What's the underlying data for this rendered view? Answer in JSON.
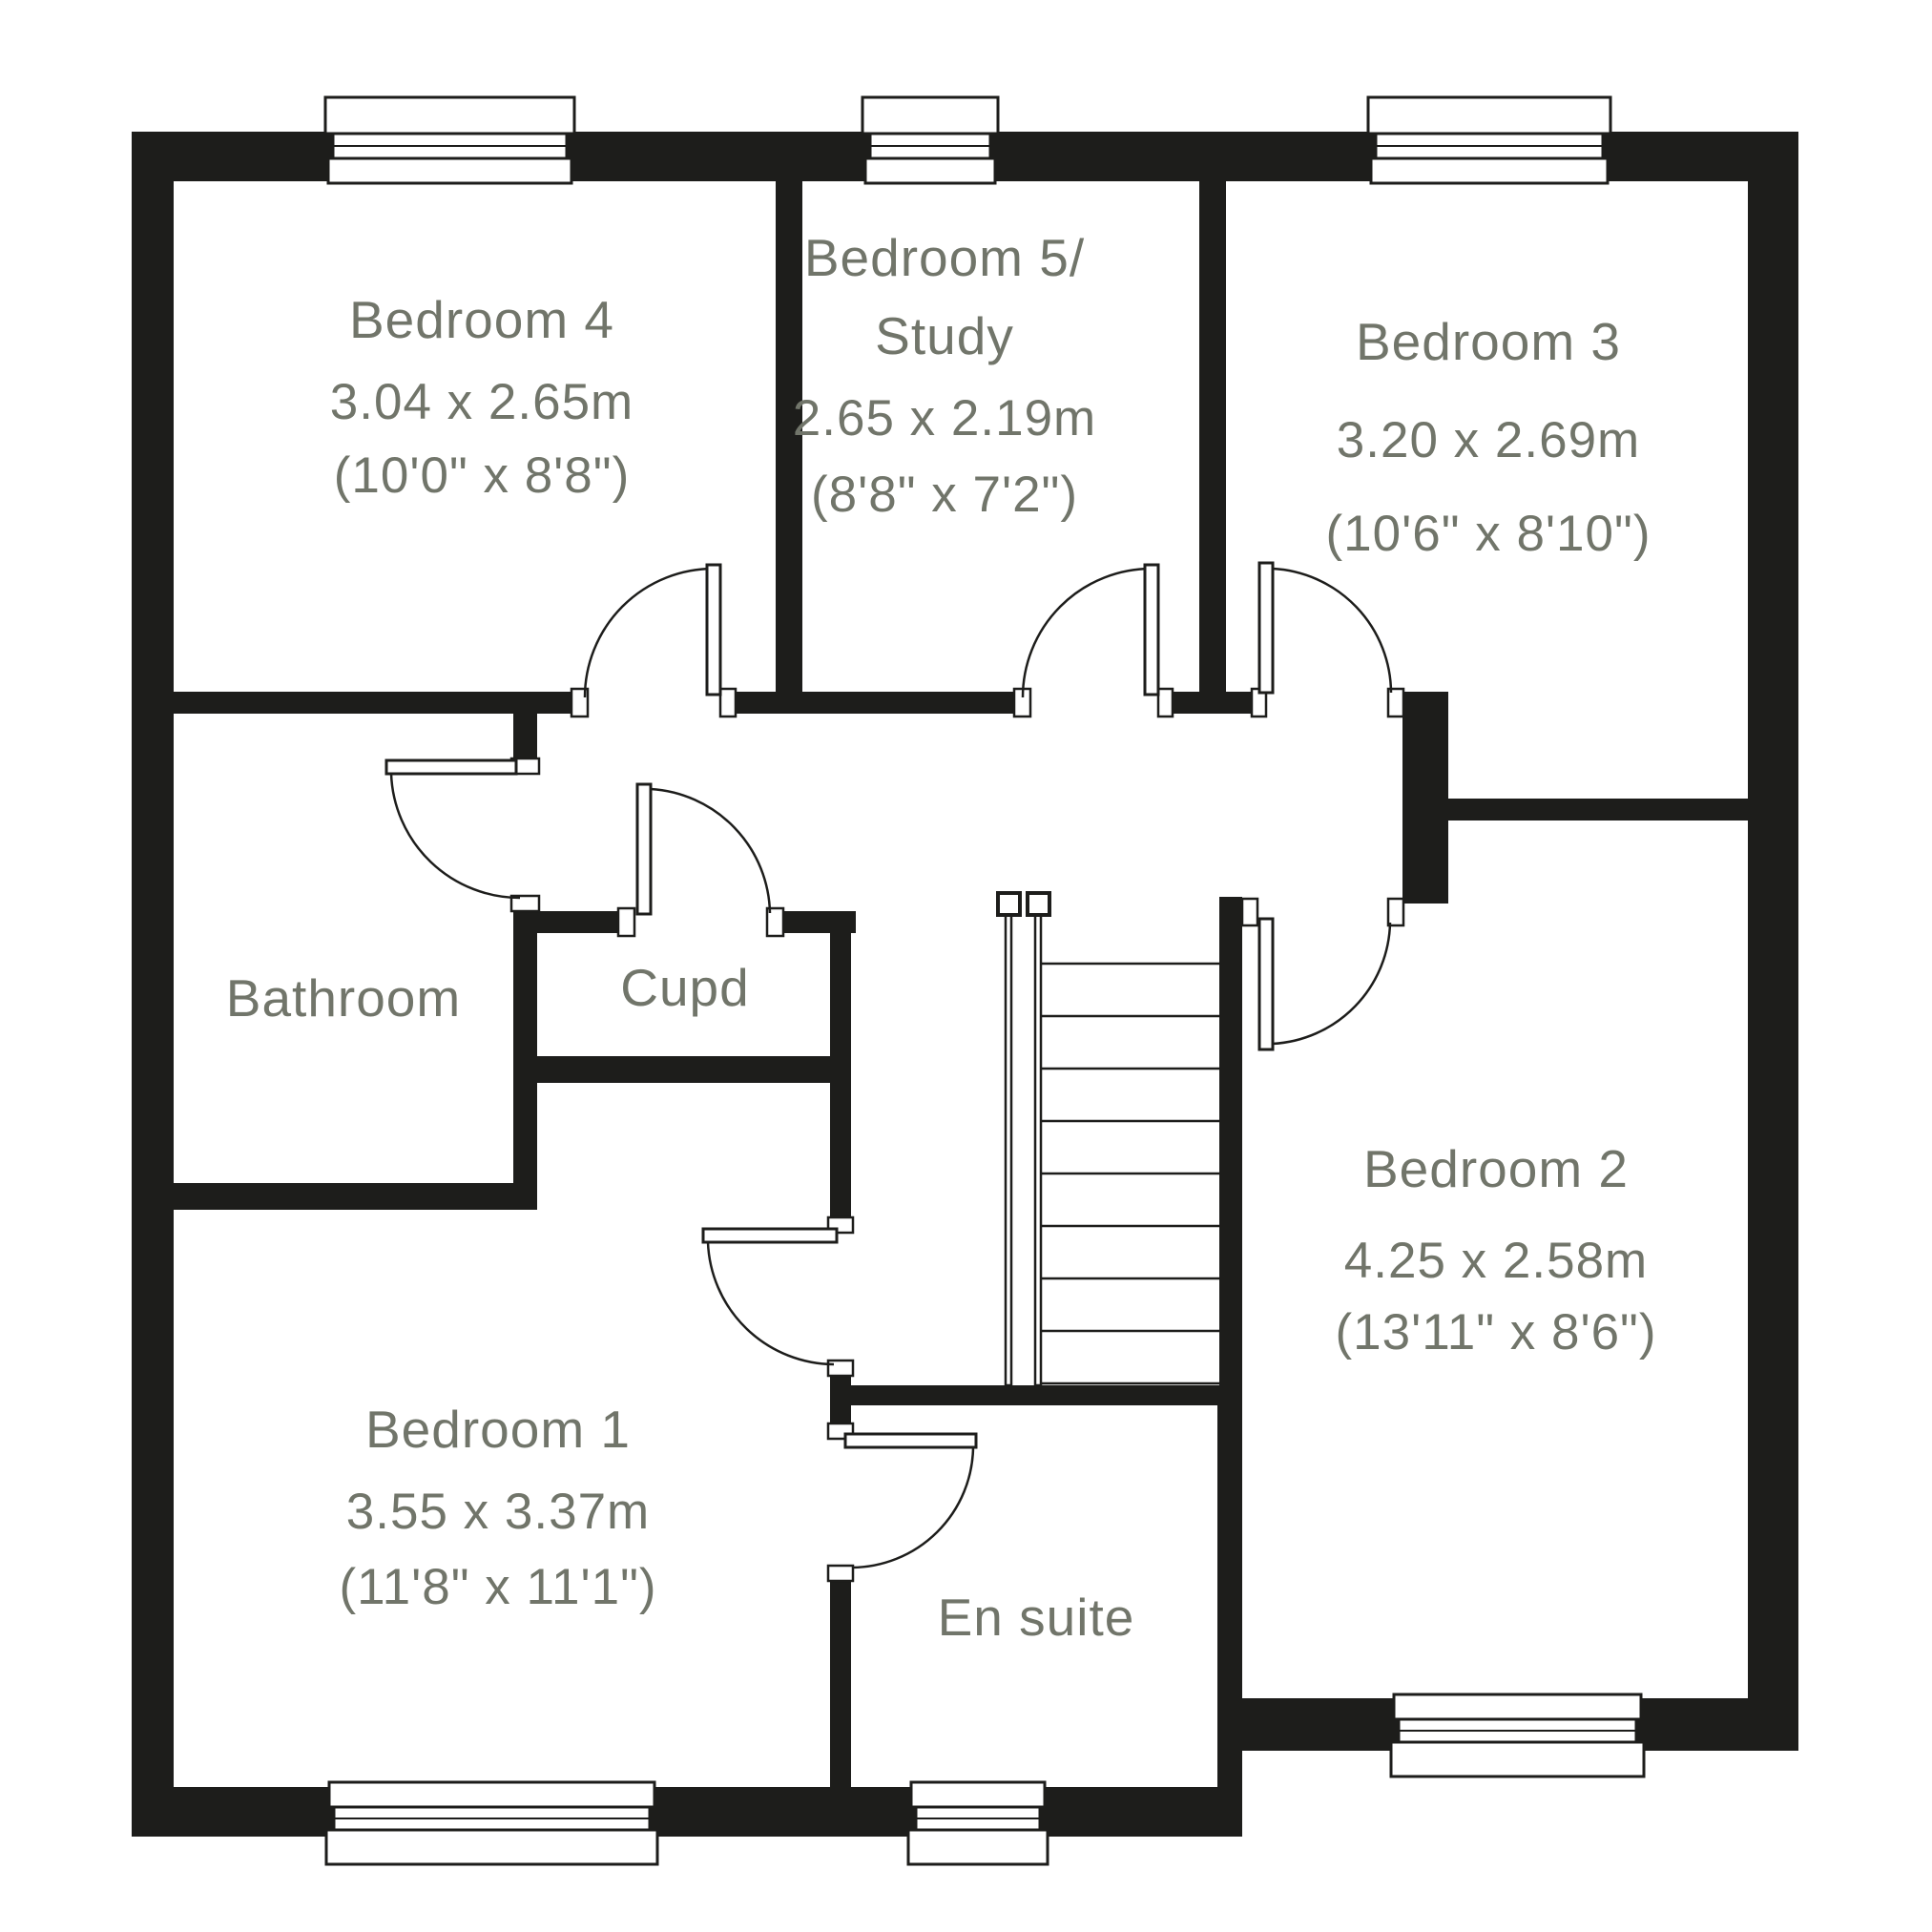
{
  "colors": {
    "wall": "#1d1d1b",
    "label": "#71756a",
    "background": "#ffffff"
  },
  "rooms": {
    "bedroom4": {
      "name": "Bedroom 4",
      "metric": "3.04 x 2.65m",
      "imperial": "(10'0\" x 8'8\")"
    },
    "bedroom5": {
      "name_line1": "Bedroom 5/",
      "name_line2": "Study",
      "metric": "2.65 x 2.19m",
      "imperial": "(8'8\" x 7'2\")"
    },
    "bedroom3": {
      "name": "Bedroom 3",
      "metric": "3.20 x 2.69m",
      "imperial": "(10'6\" x 8'10\")"
    },
    "bathroom": {
      "name": "Bathroom"
    },
    "cupboard": {
      "name": "Cupd"
    },
    "bedroom1": {
      "name": "Bedroom 1",
      "metric": "3.55 x 3.37m",
      "imperial": "(11'8\" x 11'1\")"
    },
    "ensuite": {
      "name": "En suite"
    },
    "bedroom2": {
      "name": "Bedroom 2",
      "metric": "4.25 x 2.58m",
      "imperial": "(13'11\" x 8'6\")"
    }
  }
}
